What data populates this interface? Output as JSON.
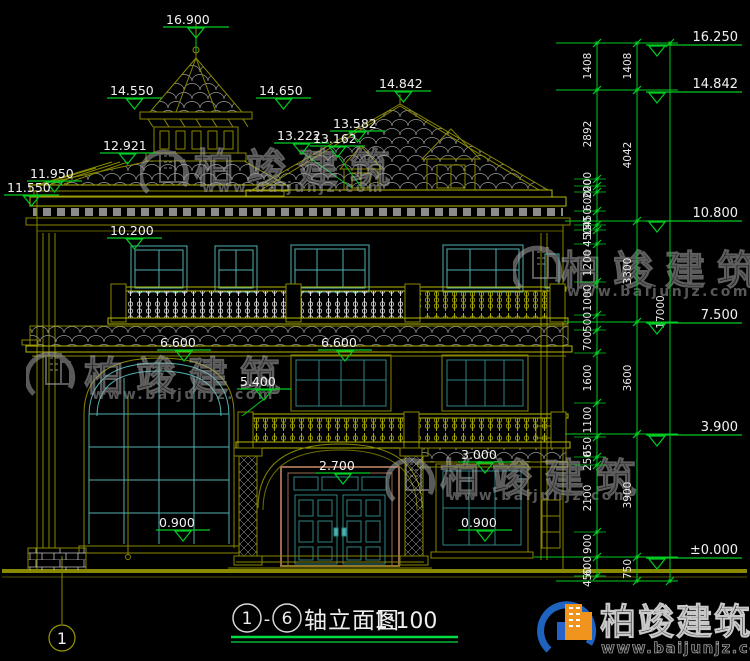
{
  "title": {
    "axis_start": "1",
    "separator": "-",
    "axis_end": "6",
    "name": "轴立面图",
    "scale": "1:100"
  },
  "axis_bubble": {
    "label": "1"
  },
  "watermark": {
    "brand": "柏竣建筑",
    "url": "www.baijunjz.com"
  },
  "logo": {
    "brand": "柏竣建筑",
    "url": "www.baijunjz.com"
  },
  "colors": {
    "background": "#000000",
    "drawing_olive": "#878700",
    "drawing_bright": "#b8b800",
    "window_cyan": "#4fb0b0",
    "door_teal": "#2f8585",
    "frame_brown": "#9a6a50",
    "dimension_green": "#00cc22",
    "label_white": "#f2f2f2",
    "watermark_gray": "#a0a0a0",
    "logo_blue": "#1f63c0",
    "logo_orange": "#f0941e",
    "title_underline_green": "#00dd44"
  },
  "elevation_markers": [
    {
      "text": "16.900",
      "x": 163,
      "y": 27,
      "w": 66
    },
    {
      "text": "14.550",
      "x": 107,
      "y": 98,
      "w": 55
    },
    {
      "text": "14.650",
      "x": 256,
      "y": 98,
      "w": 55
    },
    {
      "text": "14.842",
      "x": 376,
      "y": 91,
      "w": 55
    },
    {
      "text": "13.582",
      "x": 330,
      "y": 131,
      "w": 55
    },
    {
      "text": "13.222",
      "x": 274,
      "y": 143,
      "w": 55
    },
    {
      "text": "13.162",
      "x": 310,
      "y": 146,
      "w": 55
    },
    {
      "text": "12.921",
      "x": 100,
      "y": 153,
      "w": 55
    },
    {
      "text": "11.950",
      "x": 27,
      "y": 181,
      "w": 55
    },
    {
      "text": "11.550",
      "x": 4,
      "y": 195,
      "w": 55
    },
    {
      "text": "10.200",
      "x": 107,
      "y": 238,
      "w": 55
    },
    {
      "text": "6.600",
      "x": 157,
      "y": 350,
      "w": 54
    },
    {
      "text": "6.600",
      "x": 318,
      "y": 350,
      "w": 54
    },
    {
      "text": "5.400",
      "x": 237,
      "y": 389,
      "w": 54
    },
    {
      "text": "2.700",
      "x": 316,
      "y": 473,
      "w": 54
    },
    {
      "text": "3.000",
      "x": 458,
      "y": 462,
      "w": 54
    },
    {
      "text": "0.900",
      "x": 156,
      "y": 530,
      "w": 54
    },
    {
      "text": "0.900",
      "x": 458,
      "y": 530,
      "w": 54
    }
  ],
  "right_markers": [
    {
      "text": "16.250",
      "y": 45
    },
    {
      "text": "14.842",
      "y": 92
    },
    {
      "text": "10.800",
      "y": 221
    },
    {
      "text": "7.500",
      "y": 323
    },
    {
      "text": "3.900",
      "y": 435
    },
    {
      "text": "±0.000",
      "y": 558
    }
  ],
  "dim_chains": [
    {
      "x": 597,
      "y1": 43,
      "y2": 578,
      "segments": [
        {
          "v": "1408",
          "y": 66
        },
        {
          "v": "2892",
          "y": 134
        },
        {
          "v": "200",
          "y": 182
        },
        {
          "v": "200",
          "y": 189
        },
        {
          "v": "600",
          "y": 201
        },
        {
          "v": "450",
          "y": 218
        },
        {
          "v": "150",
          "y": 227
        },
        {
          "v": "450",
          "y": 237
        },
        {
          "v": "1200",
          "y": 263
        },
        {
          "v": "1000",
          "y": 298
        },
        {
          "v": "500",
          "y": 322
        },
        {
          "v": "700",
          "y": 341
        },
        {
          "v": "1600",
          "y": 378
        },
        {
          "v": "1100",
          "y": 420
        },
        {
          "v": "650",
          "y": 447
        },
        {
          "v": "250",
          "y": 461
        },
        {
          "v": "2100",
          "y": 498
        },
        {
          "v": "900",
          "y": 544
        },
        {
          "v": "600",
          "y": 566
        },
        {
          "v": "450",
          "y": 577
        }
      ],
      "ticks": [
        43,
        90,
        179,
        186,
        192,
        211,
        225,
        230,
        244,
        282,
        315,
        330,
        353,
        403,
        437,
        457,
        465,
        532,
        557,
        576
      ]
    },
    {
      "x": 637,
      "y1": 43,
      "y2": 581,
      "segments": [
        {
          "v": "1408",
          "y": 66
        },
        {
          "v": "4042",
          "y": 155
        },
        {
          "v": "3300",
          "y": 271
        },
        {
          "v": "3600",
          "y": 378
        },
        {
          "v": "3900",
          "y": 495
        },
        {
          "v": "750",
          "y": 569
        }
      ],
      "ticks": [
        43,
        90,
        221,
        322,
        434,
        557,
        581
      ]
    },
    {
      "x": 670,
      "y1": 43,
      "y2": 581,
      "segments": [
        {
          "v": "17000",
          "y": 312
        }
      ],
      "ticks": [
        43,
        581
      ]
    }
  ]
}
